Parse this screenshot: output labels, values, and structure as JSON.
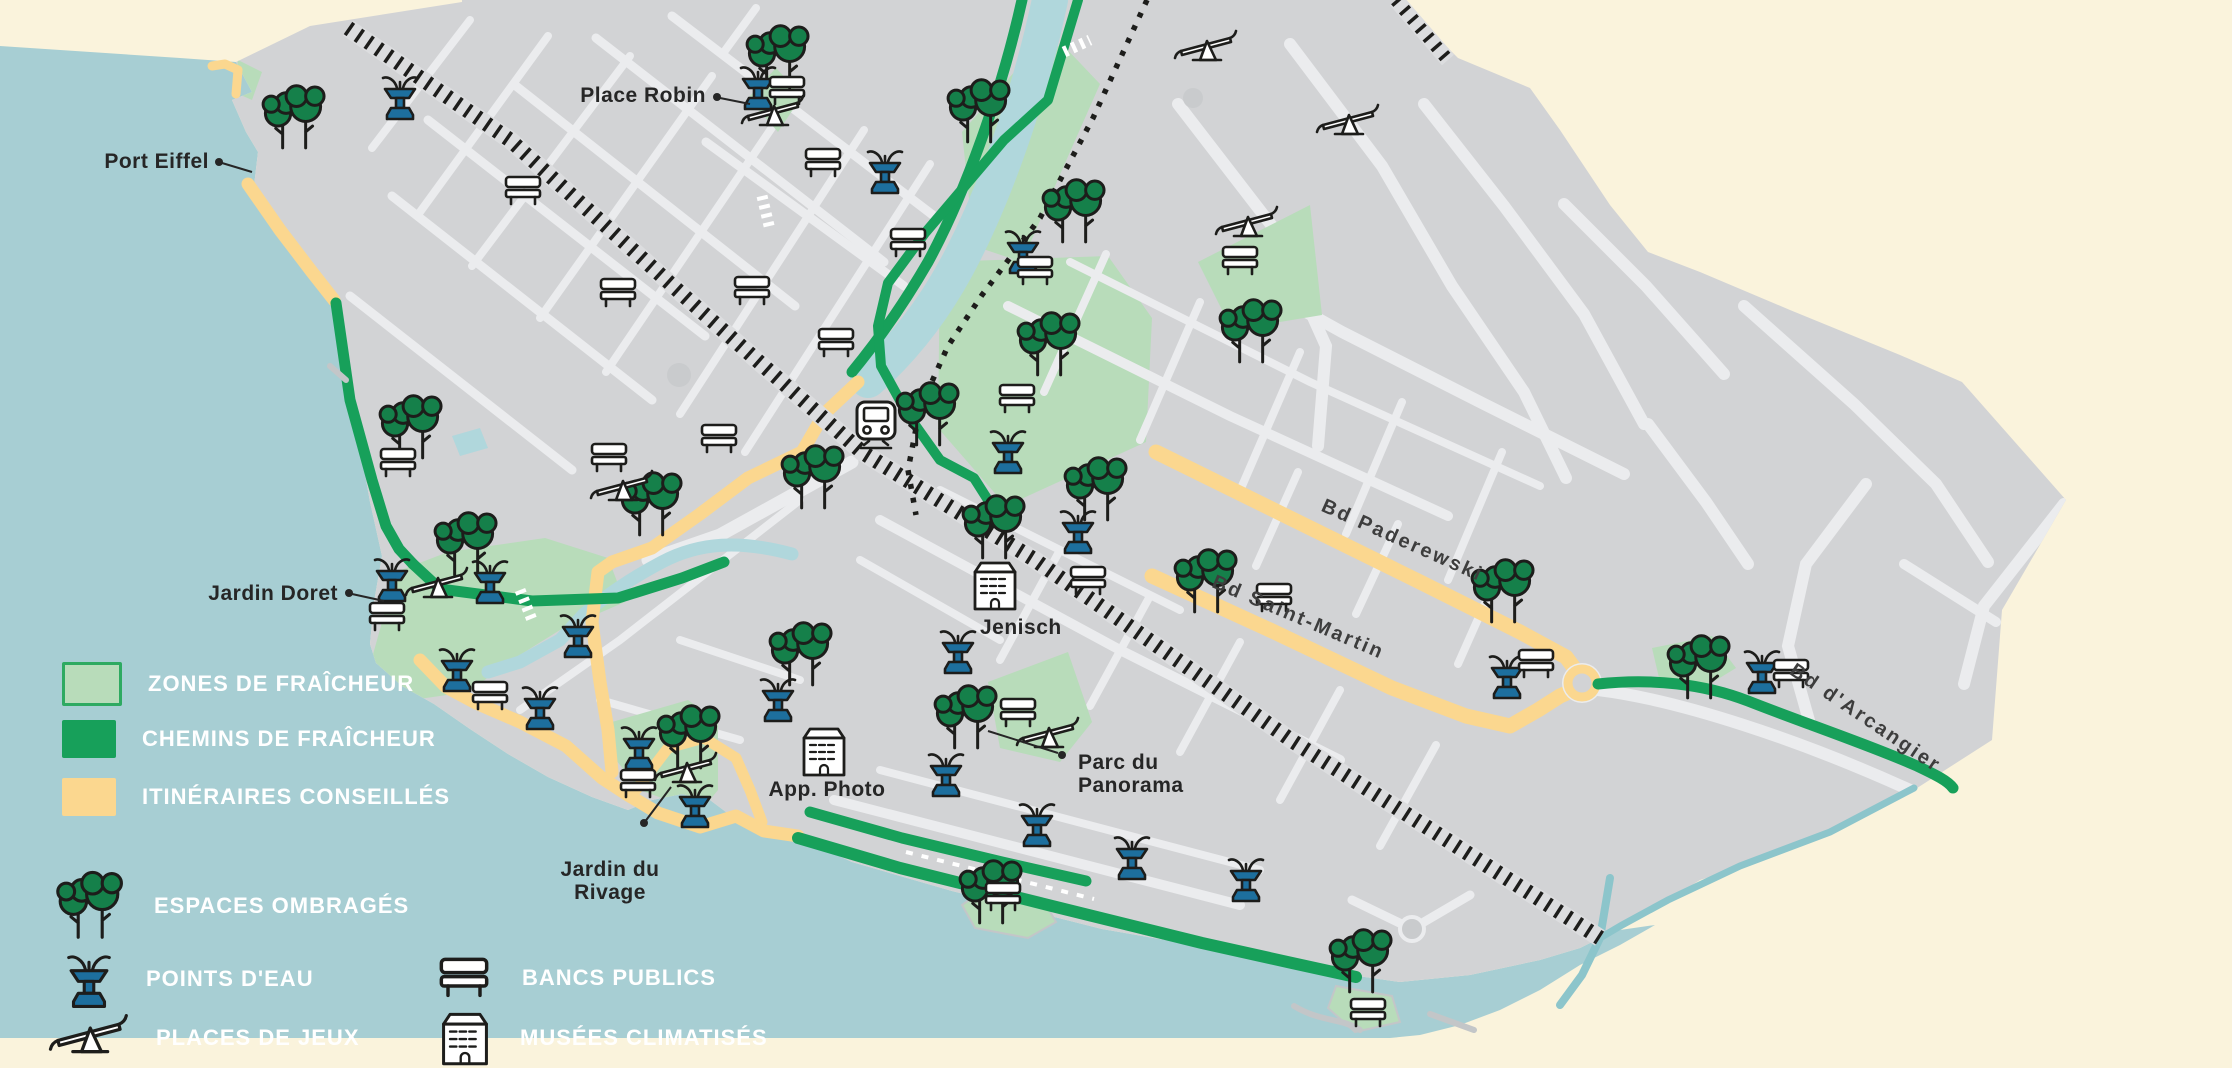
{
  "title": "Carte des zones de fraîcheur",
  "colors": {
    "lake": "#a7ced3",
    "land": "#d2d3d5",
    "street": "#ebecee",
    "outside": "#faf3dc",
    "cool_zone": "#b8dcba",
    "cool_zone_border": "#2eaa61",
    "cool_path": "#17a05a",
    "advised_route": "#fbd78f",
    "river": "#b0d7dc",
    "ink": "#1d1d1b",
    "water_icon": "#1d6f9e",
    "tree": "#15804a",
    "label": "#262626",
    "street_label": "#3d3d3d",
    "legend_text": "#ffffff"
  },
  "legend": {
    "areas": [
      {
        "label": "ZONES DE FRAÎCHEUR",
        "swatch": "cool_zone"
      },
      {
        "label": "CHEMINS DE FRAÎCHEUR",
        "swatch": "cool_path"
      },
      {
        "label": "ITINÉRAIRES CONSEILLÉS",
        "swatch": "advised_route"
      }
    ],
    "markers": [
      {
        "label": "ESPACES OMBRAGÉS",
        "icon": "trees-icon"
      },
      {
        "label": "POINTS D'EAU",
        "icon": "fountain-icon"
      },
      {
        "label": "PLACES DE JEUX",
        "icon": "seesaw-icon"
      },
      {
        "label": "BANCS PUBLICS",
        "icon": "bench-icon"
      },
      {
        "label": "MUSÉES CLIMATISÉS",
        "icon": "museum-icon"
      }
    ]
  },
  "map": {
    "region_labels": [
      {
        "text": "Port Eiffel",
        "x": 209,
        "y": 168,
        "anchor": "end",
        "dot": [
          219,
          162
        ],
        "leader": [
          [
            222,
            163
          ],
          [
            252,
            172
          ]
        ]
      },
      {
        "text": "Place Robin",
        "x": 706,
        "y": 102,
        "anchor": "end",
        "dot": [
          717,
          97
        ],
        "leader": [
          [
            720,
            98
          ],
          [
            750,
            104
          ]
        ]
      },
      {
        "text": "Jardin Doret",
        "x": 338,
        "y": 600,
        "anchor": "end",
        "dot": [
          349,
          593
        ],
        "leader": [
          [
            352,
            594
          ],
          [
            384,
            601
          ]
        ]
      },
      {
        "text": "Jardin du\nRivage",
        "x": 610,
        "y": 876,
        "anchor": "middle",
        "dot": [
          644,
          823
        ],
        "leader": [
          [
            644,
            823
          ],
          [
            671,
            787
          ]
        ]
      },
      {
        "text": "Parc du\nPanorama",
        "x": 1078,
        "y": 769,
        "anchor": "start",
        "dot": [
          1062,
          755
        ],
        "leader": [
          [
            1058,
            753
          ],
          [
            988,
            731
          ]
        ]
      }
    ],
    "street_labels": [
      {
        "text": "Bd Paderewski",
        "x": 1400,
        "y": 546,
        "rotate": 24
      },
      {
        "text": "Bd Saint-Martin",
        "x": 1296,
        "y": 623,
        "rotate": 23
      },
      {
        "text": "Bd d'Arcangier",
        "x": 1862,
        "y": 723,
        "rotate": 34
      }
    ],
    "poi_labels": [
      {
        "text": "Jenisch",
        "x": 980,
        "y": 634,
        "anchor": "start"
      },
      {
        "text": "App. Photo",
        "x": 827,
        "y": 796,
        "anchor": "middle"
      }
    ]
  },
  "icons": {
    "trees": [
      [
        293,
        118
      ],
      [
        777,
        58
      ],
      [
        978,
        112
      ],
      [
        1073,
        212
      ],
      [
        1048,
        345
      ],
      [
        927,
        415
      ],
      [
        993,
        528
      ],
      [
        1095,
        490
      ],
      [
        1250,
        332
      ],
      [
        1205,
        582
      ],
      [
        1502,
        592
      ],
      [
        1698,
        668
      ],
      [
        410,
        428
      ],
      [
        465,
        545
      ],
      [
        650,
        505
      ],
      [
        812,
        478
      ],
      [
        800,
        655
      ],
      [
        965,
        718
      ],
      [
        688,
        738
      ],
      [
        990,
        893
      ],
      [
        1360,
        962
      ]
    ],
    "fountains": [
      [
        400,
        98
      ],
      [
        758,
        88
      ],
      [
        885,
        172
      ],
      [
        1023,
        252
      ],
      [
        1008,
        452
      ],
      [
        1078,
        532
      ],
      [
        958,
        652
      ],
      [
        392,
        580
      ],
      [
        490,
        582
      ],
      [
        457,
        670
      ],
      [
        540,
        708
      ],
      [
        578,
        636
      ],
      [
        639,
        748
      ],
      [
        695,
        806
      ],
      [
        778,
        700
      ],
      [
        946,
        775
      ],
      [
        1037,
        825
      ],
      [
        1132,
        858
      ],
      [
        1246,
        880
      ],
      [
        1507,
        677
      ],
      [
        1762,
        672
      ]
    ],
    "benches": [
      [
        398,
        462
      ],
      [
        387,
        616
      ],
      [
        490,
        695
      ],
      [
        638,
        783
      ],
      [
        523,
        190
      ],
      [
        618,
        292
      ],
      [
        752,
        290
      ],
      [
        823,
        162
      ],
      [
        908,
        242
      ],
      [
        836,
        342
      ],
      [
        609,
        457
      ],
      [
        719,
        438
      ],
      [
        787,
        90
      ],
      [
        1035,
        270
      ],
      [
        1017,
        398
      ],
      [
        1240,
        260
      ],
      [
        1274,
        597
      ],
      [
        1536,
        663
      ],
      [
        1791,
        673
      ],
      [
        1018,
        712
      ],
      [
        1088,
        580
      ],
      [
        1003,
        896
      ],
      [
        1368,
        1012
      ]
    ],
    "seesaws": [
      [
        773,
        113
      ],
      [
        1206,
        48
      ],
      [
        1247,
        224
      ],
      [
        437,
        585
      ],
      [
        622,
        488
      ],
      [
        686,
        770
      ],
      [
        1048,
        735
      ],
      [
        1348,
        122
      ]
    ],
    "museums": [
      [
        995,
        586
      ],
      [
        824,
        752
      ]
    ],
    "station": [
      876,
      424
    ]
  }
}
